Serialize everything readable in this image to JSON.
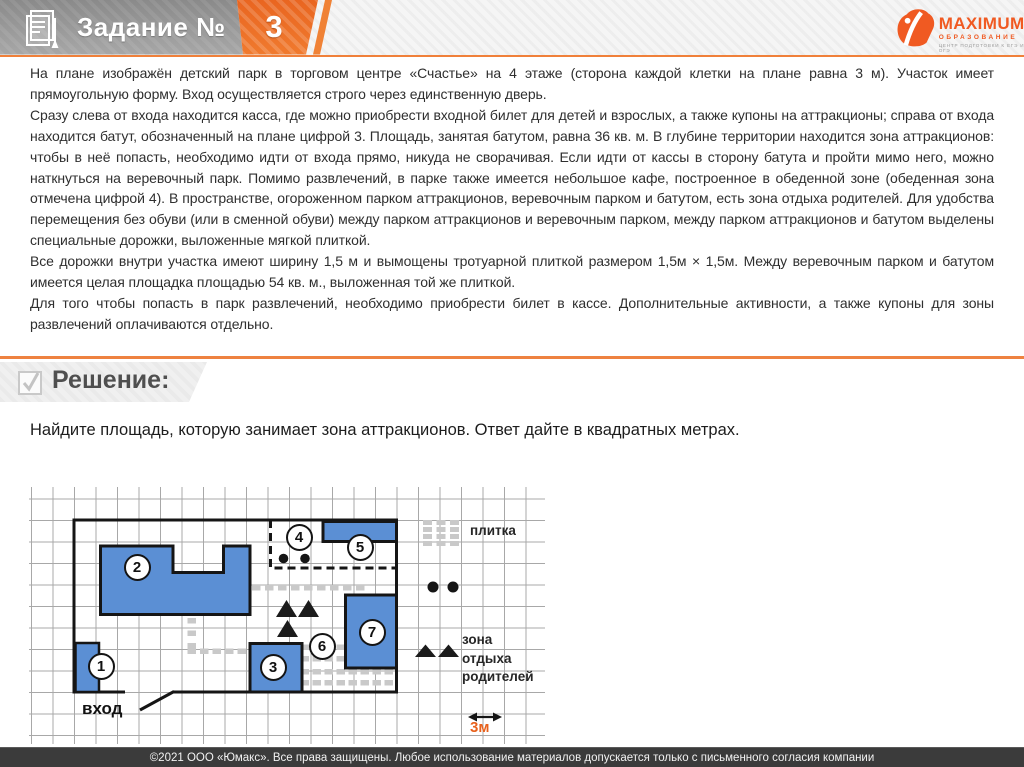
{
  "header": {
    "task_label": "Задание №",
    "task_number": "3",
    "logo": {
      "brand": "MAXIMUM",
      "subtitle": "ОБРАЗОВАНИЕ",
      "tagline": "ЦЕНТР ПОДГОТОВКИ К ЕГЭ И ОГЭ"
    }
  },
  "problem": {
    "paragraphs": [
      "На плане изображён детский парк в торговом центре «Счастье» на 4 этаже (сторона каждой клетки на плане равна 3 м). Участок имеет прямоугольную форму. Вход осуществляется строго через единственную дверь.",
      "Сразу слева от входа находится касса, где можно приобрести входной билет для детей и взрослых, а также купоны на аттракционы; справа от входа находится батут, обозначенный на плане цифрой 3. Площадь, занятая батутом, равна 36 кв. м. В глубине территории находится зона аттракционов: чтобы в неё попасть, необходимо идти от входа прямо, никуда не сворачивая. Если идти от кассы в сторону батута и пройти мимо него, можно наткнуться на веревочный парк. Помимо развлечений, в парке также имеется небольшое кафе, построенное в обеденной зоне (обеденная зона отмечена цифрой 4). В пространстве, огороженном парком аттракционов, веревочным парком и батутом, есть зона отдыха родителей. Для удобства перемещения без обуви (или в сменной обуви) между парком аттракционов и веревочным парком, между парком аттракционов и батутом выделены специальные дорожки, выложенные мягкой плиткой.",
      "Все дорожки внутри участка имеют ширину 1,5 м и вымощены тротуарной плиткой размером 1,5м × 1,5м.  Между веревочным парком и батутом имеется целая площадка площадью 54 кв. м., выложенная той же плиткой.",
      "Для того чтобы попасть в парк развлечений, необходимо приобрести билет в кассе. Дополнительные активности, а также купоны для зоны развлечений оплачиваются отдельно."
    ]
  },
  "solution": {
    "title": "Решение:",
    "question": "Найдите площадь, которую занимает зона аттракционов. Ответ дайте в квадратных метрах."
  },
  "plan": {
    "markers": [
      "1",
      "2",
      "3",
      "4",
      "5",
      "6",
      "7"
    ],
    "entrance_label": "вход",
    "scale_label": "3м",
    "legend": {
      "tile": "плитка",
      "rest_zone_lines": [
        "зона",
        "отдыха",
        "родителей"
      ]
    }
  },
  "footer": {
    "copyright": "©2021 ООО «Юмакс». Все права защищены. Любое использование материалов допускается только с  письменного согласия компании"
  }
}
